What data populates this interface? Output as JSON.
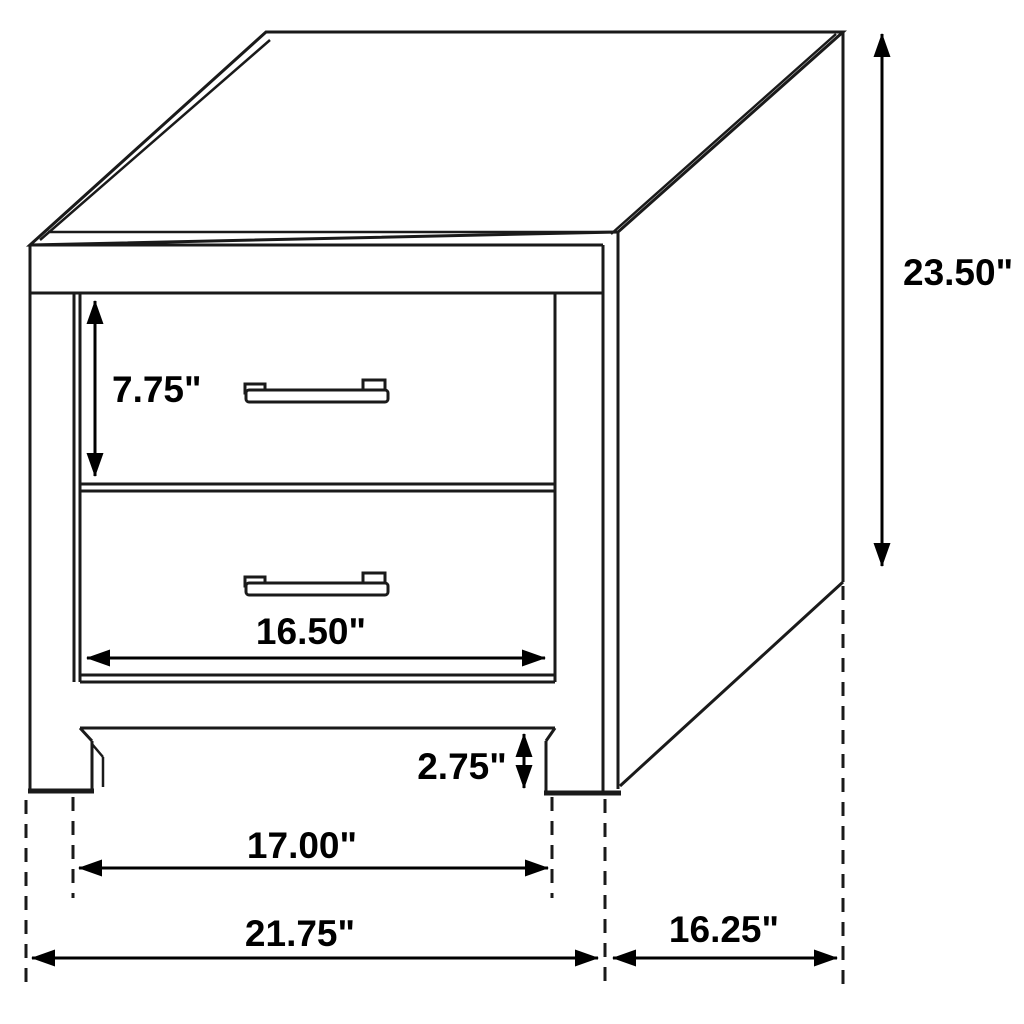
{
  "diagram": {
    "title": "Two-drawer nightstand dimension drawing",
    "unit": "inches",
    "colors": {
      "line": "#1a1a1a",
      "text": "#000000",
      "background": "#ffffff"
    },
    "object": {
      "type": "nightstand",
      "drawer_count": 2,
      "handle_style": "bar-pull"
    },
    "dimensions": {
      "overall_height": {
        "label": "23.50\"",
        "value": 23.5,
        "measures": "total height, floor to top"
      },
      "drawer_height": {
        "label": "7.75\"",
        "value": 7.75,
        "measures": "drawer front height"
      },
      "drawer_width": {
        "label": "16.50\"",
        "value": 16.5,
        "measures": "drawer opening width"
      },
      "leg_clearance": {
        "label": "2.75\"",
        "value": 2.75,
        "measures": "leg height below bottom rail"
      },
      "inner_width": {
        "label": "17.00\"",
        "value": 17.0,
        "measures": "width between legs, inside to inside"
      },
      "overall_width": {
        "label": "21.75\"",
        "value": 21.75,
        "measures": "total width, outside to outside"
      },
      "depth": {
        "label": "16.25\"",
        "value": 16.25,
        "measures": "side depth front to back"
      }
    }
  }
}
